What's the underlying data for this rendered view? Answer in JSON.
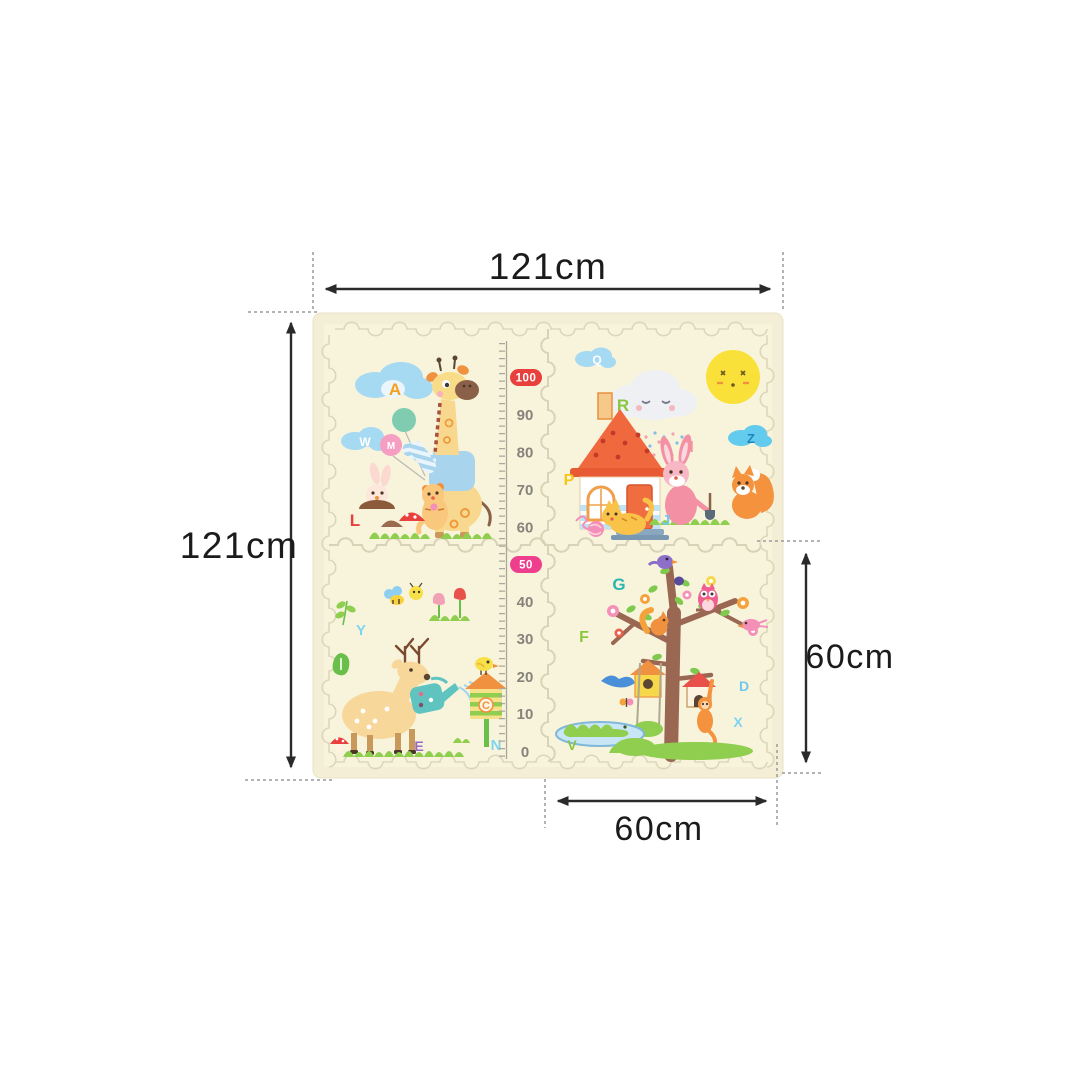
{
  "diagram": {
    "width_label": "121cm",
    "height_label": "121cm",
    "tile_width_label": "60cm",
    "tile_height_label": "60cm"
  },
  "growth_ruler": {
    "upper_badge": "100",
    "upper_ticks": [
      "90",
      "80",
      "70",
      "60"
    ],
    "lower_badge": "50",
    "lower_ticks": [
      "40",
      "30",
      "20",
      "10",
      "0"
    ]
  },
  "alphabet_letters": {
    "top_left": [
      "A",
      "W",
      "M",
      "L"
    ],
    "top_right": [
      "Q",
      "R",
      "H",
      "Z",
      "P",
      "J"
    ],
    "bottom_left": [
      "Y",
      "C",
      "E",
      "N"
    ],
    "bottom_right": [
      "G",
      "F",
      "D",
      "X",
      "V"
    ]
  },
  "colors": {
    "page_bg": "#ffffff",
    "mat_bg": "#f8f4dc",
    "mat_rim": "#f3eed5",
    "puzzle_line": "#ddd6ba",
    "arrow": "#2a2a2a",
    "guide": "#9a9a9a",
    "badge_100": "#e8403c",
    "badge_50": "#ee3f8e",
    "ruler_number": "#85837b"
  }
}
